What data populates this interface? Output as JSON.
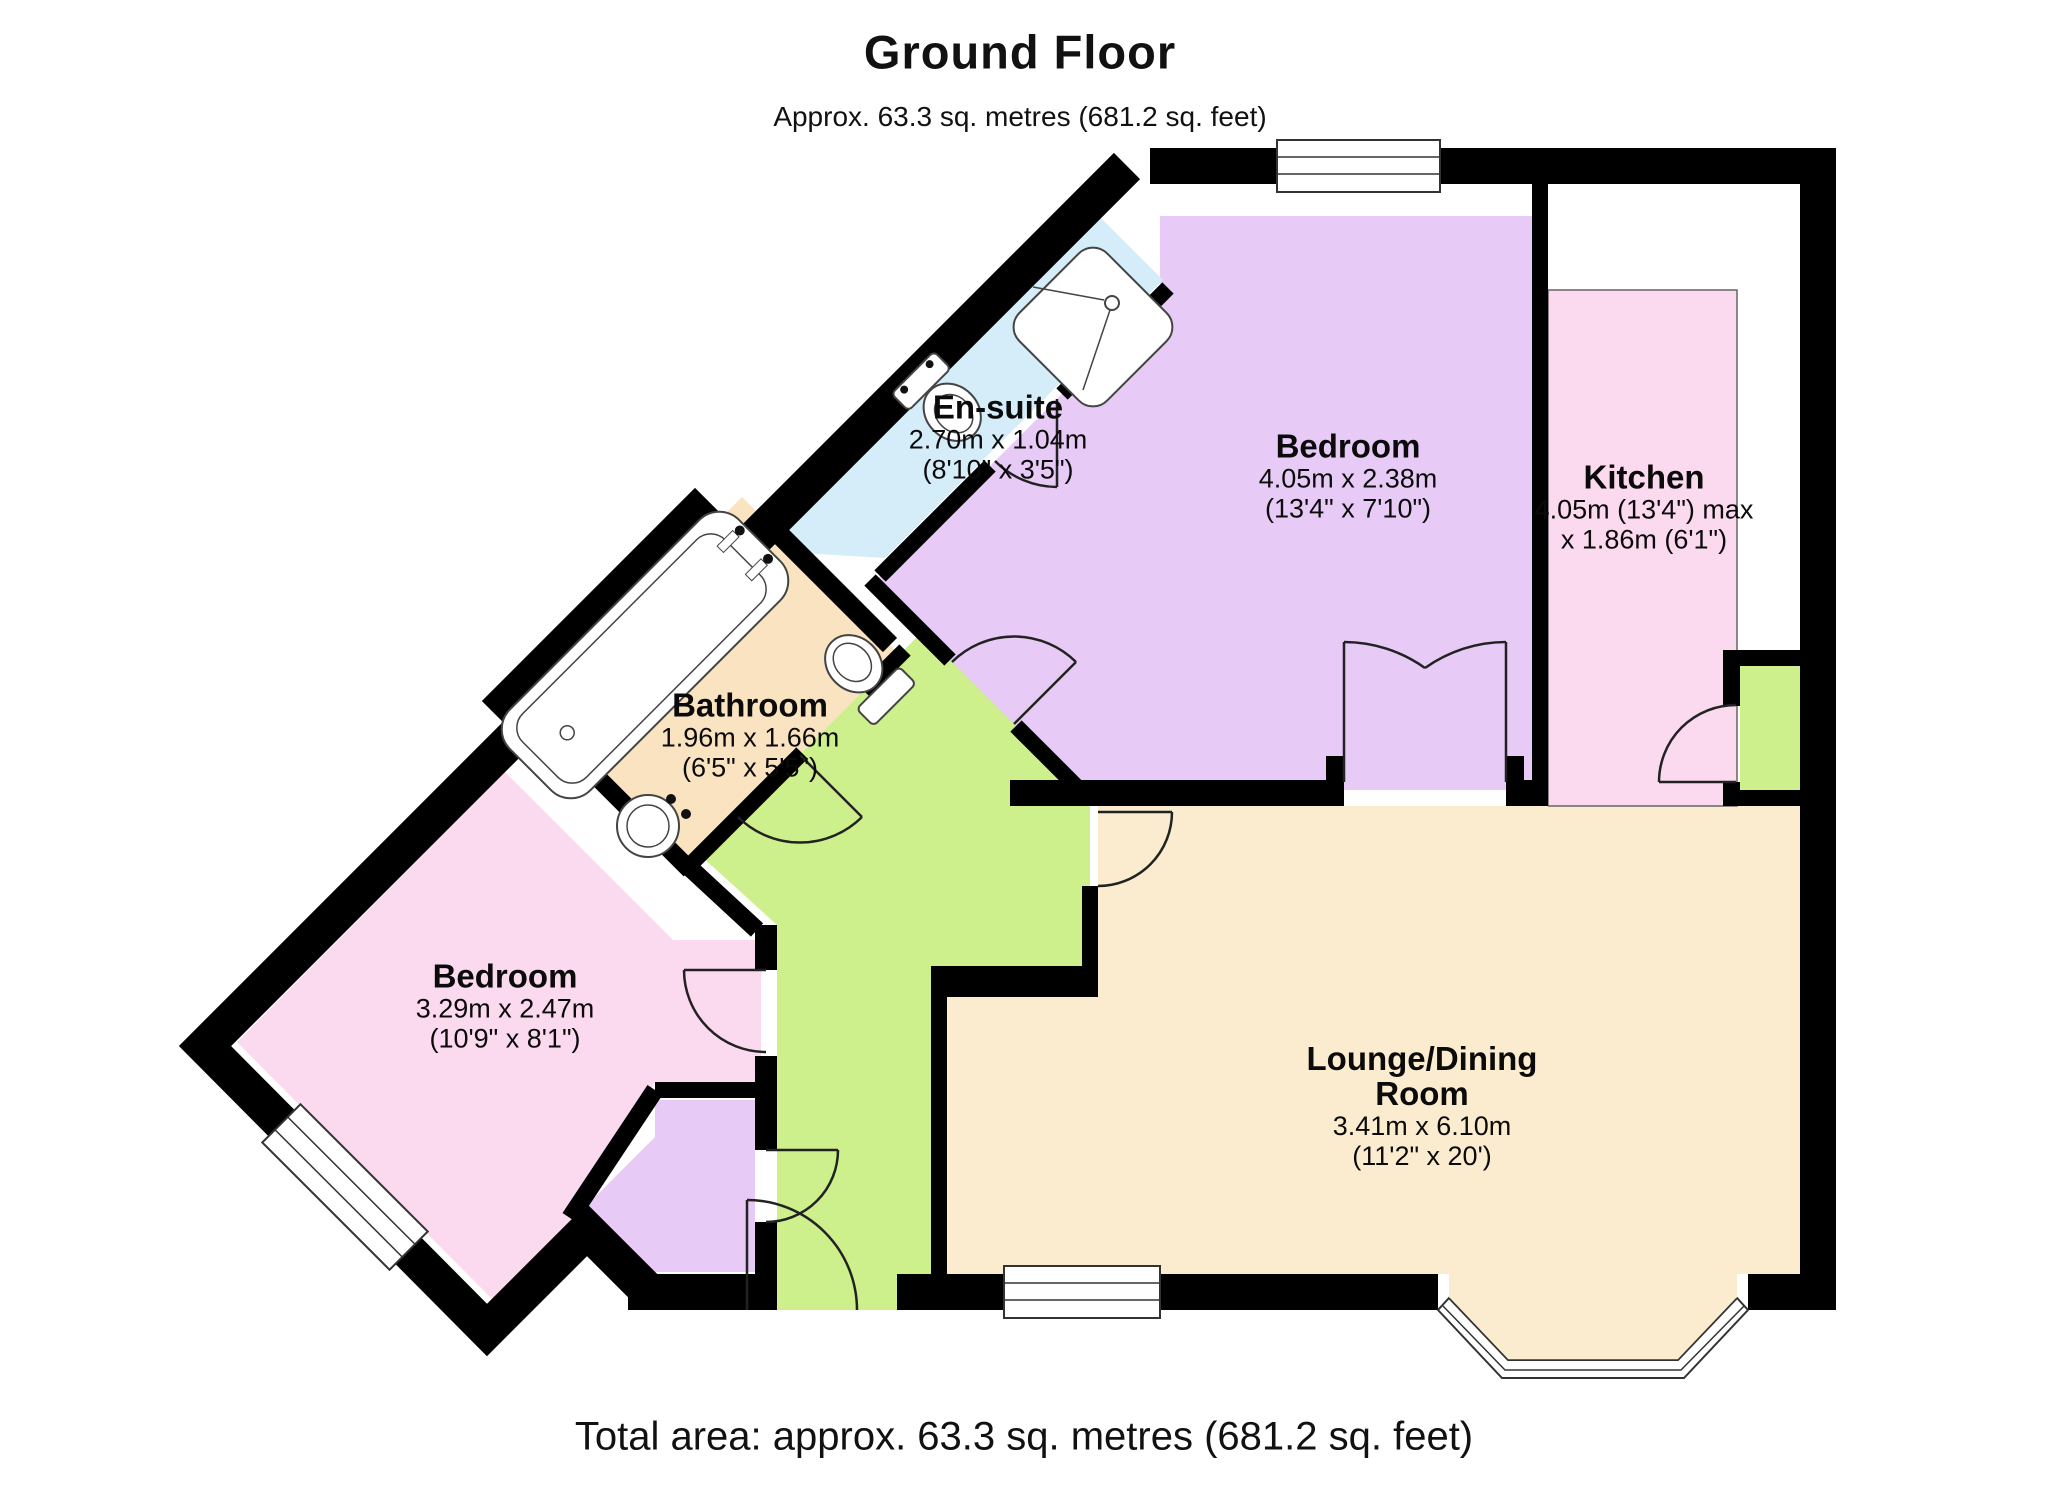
{
  "title": {
    "heading": "Ground Floor",
    "subheading": "Approx. 63.3 sq. metres (681.2 sq. feet)"
  },
  "footer": {
    "total_area": "Total area: approx. 63.3 sq. metres (681.2 sq. feet)"
  },
  "rooms": [
    {
      "id": "ensuite",
      "name": "En-suite",
      "dim_metric": "2.70m x 1.04m",
      "dim_imperial": "(8'10\" x 3'5\")",
      "color": "#d5ecf9"
    },
    {
      "id": "bedroom1",
      "name": "Bedroom",
      "dim_metric": "4.05m x 2.38m",
      "dim_imperial": "(13'4\" x 7'10\")",
      "color": "#e7cbf6"
    },
    {
      "id": "kitchen",
      "name": "Kitchen",
      "dim_metric": "4.05m (13'4\") max",
      "dim_imperial": "x 1.86m (6'1\")",
      "color": "#fbd9ee"
    },
    {
      "id": "bathroom",
      "name": "Bathroom",
      "dim_metric": "1.96m x 1.66m",
      "dim_imperial": "(6'5\" x 5'5\")",
      "color": "#fae3c1"
    },
    {
      "id": "bedroom2",
      "name": "Bedroom",
      "dim_metric": "3.29m x 2.47m",
      "dim_imperial": "(10'9\" x 8'1\")",
      "color": "#fbd9ee"
    },
    {
      "id": "lounge",
      "name": "Lounge/Dining Room",
      "dim_metric": "3.41m x 6.10m",
      "dim_imperial": "(11'2\" x 20')",
      "color": "#fbeccf"
    },
    {
      "id": "hallway",
      "name": "",
      "color": "#cdf08d"
    },
    {
      "id": "entrance-porch",
      "name": "",
      "color": "#cdf08d"
    },
    {
      "id": "lobby",
      "name": "",
      "color": "#e7cbf6"
    }
  ],
  "fixtures": [
    "shower",
    "toilet",
    "bath",
    "basin"
  ],
  "wall_color": "#000000"
}
